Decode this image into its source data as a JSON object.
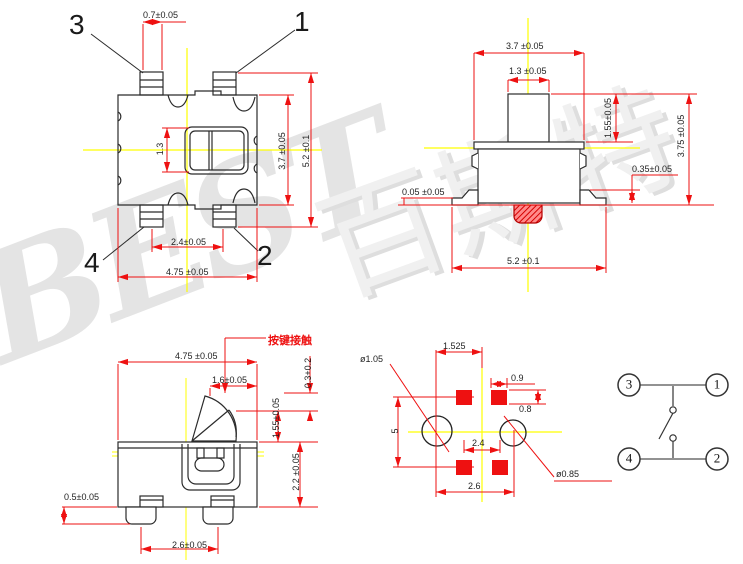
{
  "watermark": {
    "brand_latin": "BEST",
    "brand_cjk": "百斯特"
  },
  "colors": {
    "dimension_line": "#ee1111",
    "outline": "#2b2b2b",
    "centerline": "#ffff00",
    "pad_fill": "#ee1111",
    "callout_text": "#ee1111",
    "dimension_text": "#1f1f1f"
  },
  "top_view": {
    "pin3": "3",
    "pin1": "1",
    "pin4": "4",
    "pin2": "2",
    "pin_width": "0.7±0.05",
    "slot_width": "1.3",
    "body_height": "3.7 ±0.05",
    "overall_height": "5.2 ±0.1",
    "pin_pitch": "2.4±0.05",
    "body_width": "4.75 ±0.05"
  },
  "front_view": {
    "top_width": "3.7 ±0.05",
    "stem_width": "1.3 ±0.05",
    "stem_height": "1.55±0.05",
    "overall_height": "3.75 ±0.05",
    "lead_height": "0.35±0.05",
    "standoff": "0.05 ±0.05",
    "overall_width": "5.2 ±0.1"
  },
  "side_view": {
    "callout": "按键接触",
    "body_width": "4.75 ±0.05",
    "lever_width": "1.6±0.05",
    "travel": "0.3+0.2",
    "lever_height": "1.55±0.05",
    "body_height": "2.2 ±0.05",
    "pin_height": "0.5±0.05",
    "pin_pitch": "2.6±0.05"
  },
  "pcb_view": {
    "pad_offset": "1.525",
    "hole_left_dia": "ø1.05",
    "pad_width": "0.9",
    "pad_height": "0.8",
    "row_span": "5",
    "pad_pitch_x": "2.4",
    "hole_pitch": "2.6",
    "hole_right_dia": "ø0.85"
  },
  "schematic": {
    "pin3": "3",
    "pin1": "1",
    "pin4": "4",
    "pin2": "2"
  }
}
